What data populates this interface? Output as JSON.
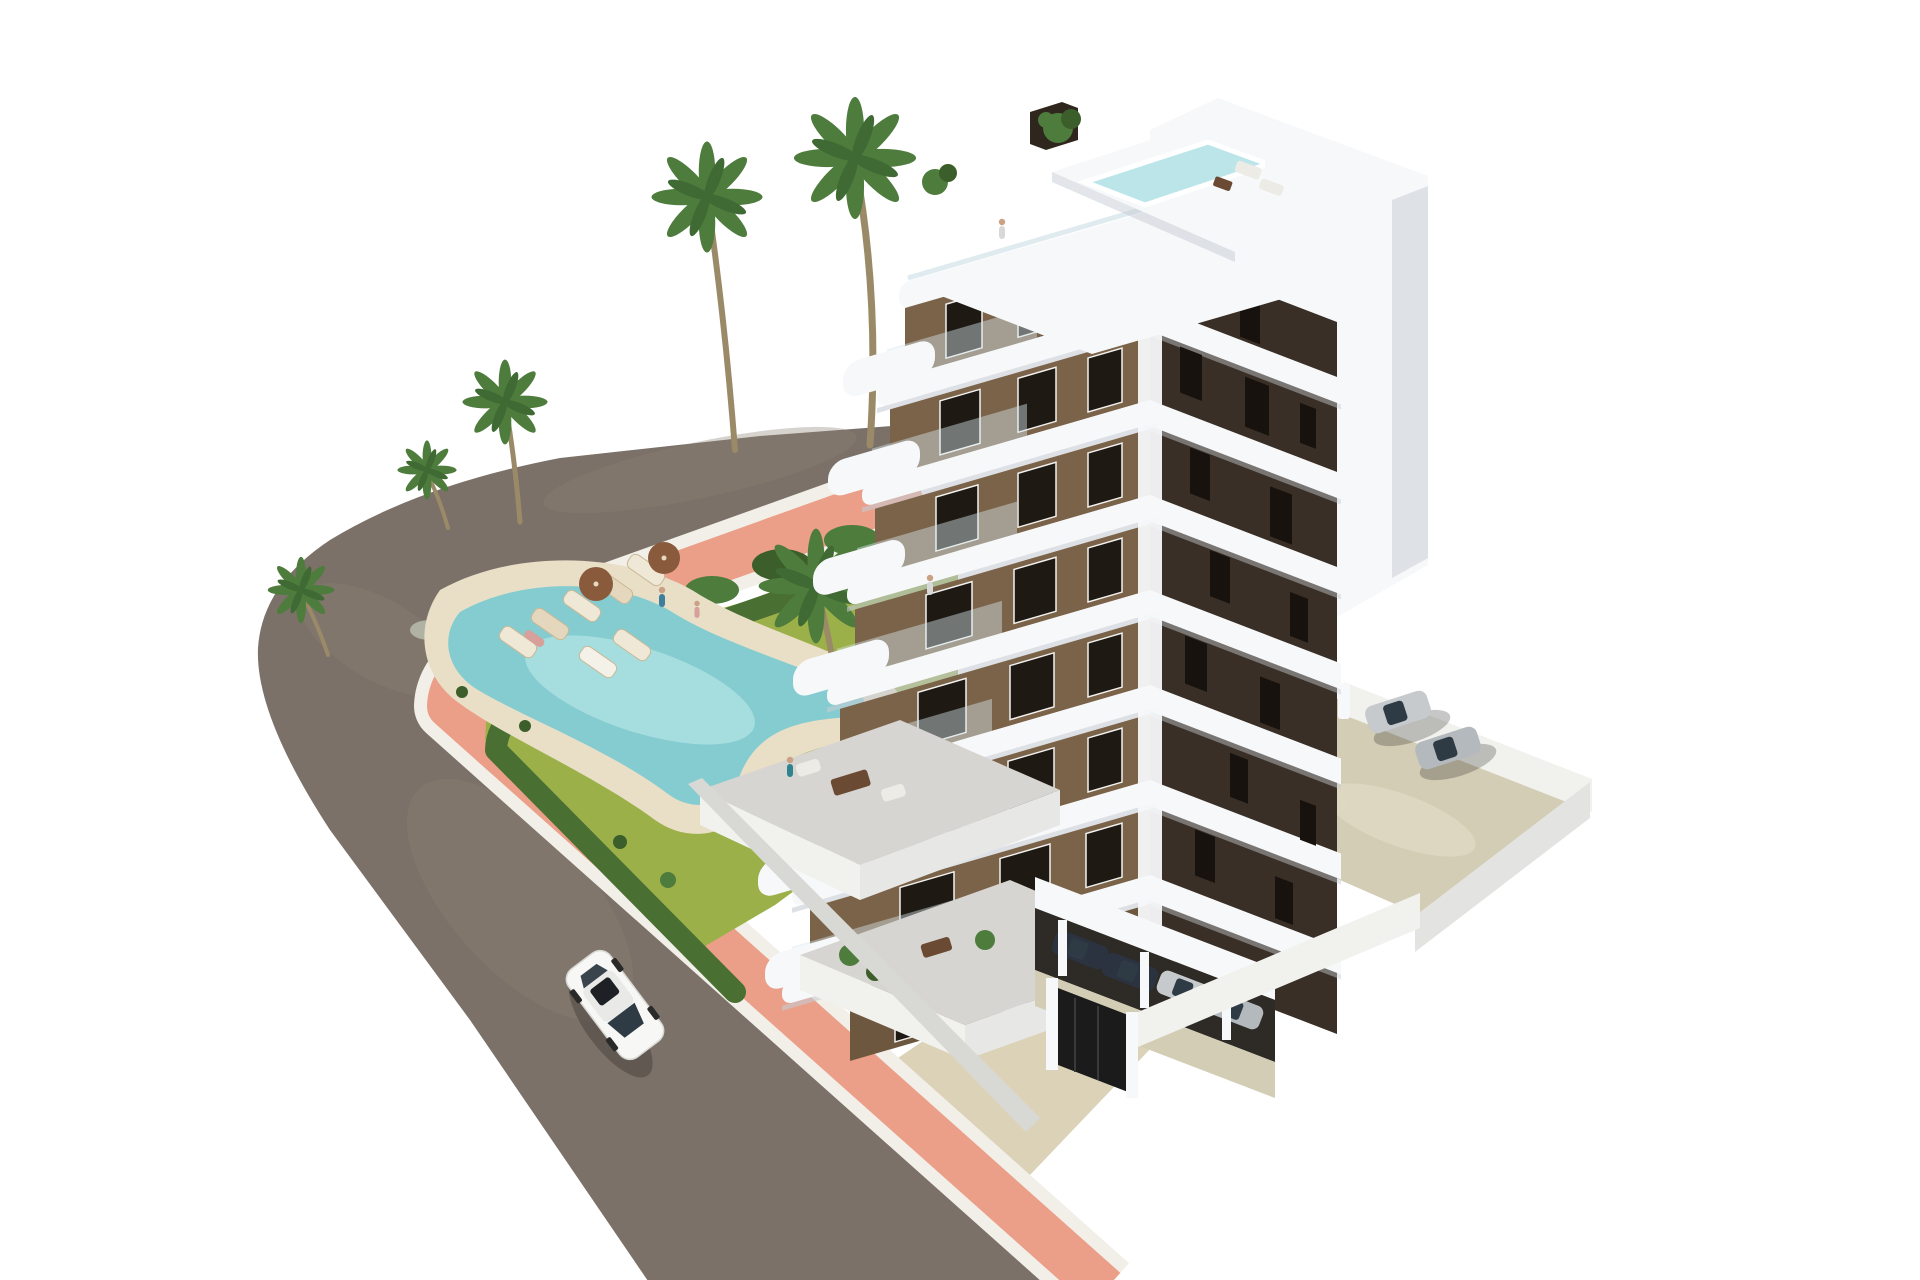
{
  "scene": {
    "description": "Aerial 3D architectural render of a modern apartment tower with white curved balconies and brown facades, rooftop terrace with plunge pool, landscaped garden with free-form swimming pool, sun loungers and palm trees, a curved asphalt road with a salmon-pink sidewalk, one white car driving on the road, and a walled parking court with parked cars",
    "building": {
      "floors_visible": 7,
      "sunlit_facade": "brown with dark framed windows and white rounded balcony slabs",
      "shaded_facade": "dark brown with white horizontal bands",
      "rooftop": "two-level white roof terrace with small plunge pool, plants and lounge furniture"
    },
    "garden": {
      "pool_shape": "free-form kidney",
      "sun_loungers": 7,
      "parasols": 2,
      "palm_trees": 7,
      "ground_terraces": 2
    },
    "vehicles": {
      "street_cars": 1,
      "parking_court_cars": 2,
      "covered_parking_cars": 4
    },
    "people_visible": 6
  },
  "colors": {
    "bg": "#ffffff",
    "asphalt": "#7b7168",
    "asphaltLight": "#8a8176",
    "curb": "#f2efe8",
    "sidewalk": "#eb9f88",
    "beige": "#dbd2b8",
    "lawn": "#9cb04a",
    "lawnDark": "#84a03c",
    "hedge": "#496f33",
    "hedgeDark": "#3c5e2a",
    "gravel": "#b9bdae",
    "sand": "#e9dfc6",
    "poolWater": "#85ccd1",
    "poolLight": "#abdfe2",
    "palm": "#4e7c3d",
    "palmDark": "#3f6a33",
    "trunk": "#9b8a68",
    "parasol": "#8a5a3c",
    "facadeSun": "#7b6349",
    "facadeSunDark": "#6e573f",
    "facadeShade": "#392f26",
    "windowDark": "#1e1913",
    "windowSlit": "#17120d",
    "white": "#f7f8fa",
    "roof": "#f6f8f9",
    "slabShade": "#c6cbd3",
    "glass": "#d8e6ec",
    "roofPool": "#bce5e9",
    "pergola": "#2f261d",
    "terraceTile": "#d7d5d1",
    "terraceWall": "#f1f1ee",
    "parkingFloor": "#d4cdb5",
    "parkingFloorLight": "#ded8c3",
    "garageShadow": "#2e2a25",
    "gate": "#1b1b1b",
    "carSilver": "#c6cacd",
    "carSilver2": "#b4b9bd",
    "carDark": "#2b3340",
    "carWhite": "#f7f7f5",
    "carGlass": "#2e3b44",
    "furniture": "#6b4a33",
    "skin": "#caa183",
    "personBlue": "#3e7f9e",
    "personTeal": "#2f8391",
    "personGray": "#d8d8d8",
    "personPink": "#d8a09a"
  }
}
